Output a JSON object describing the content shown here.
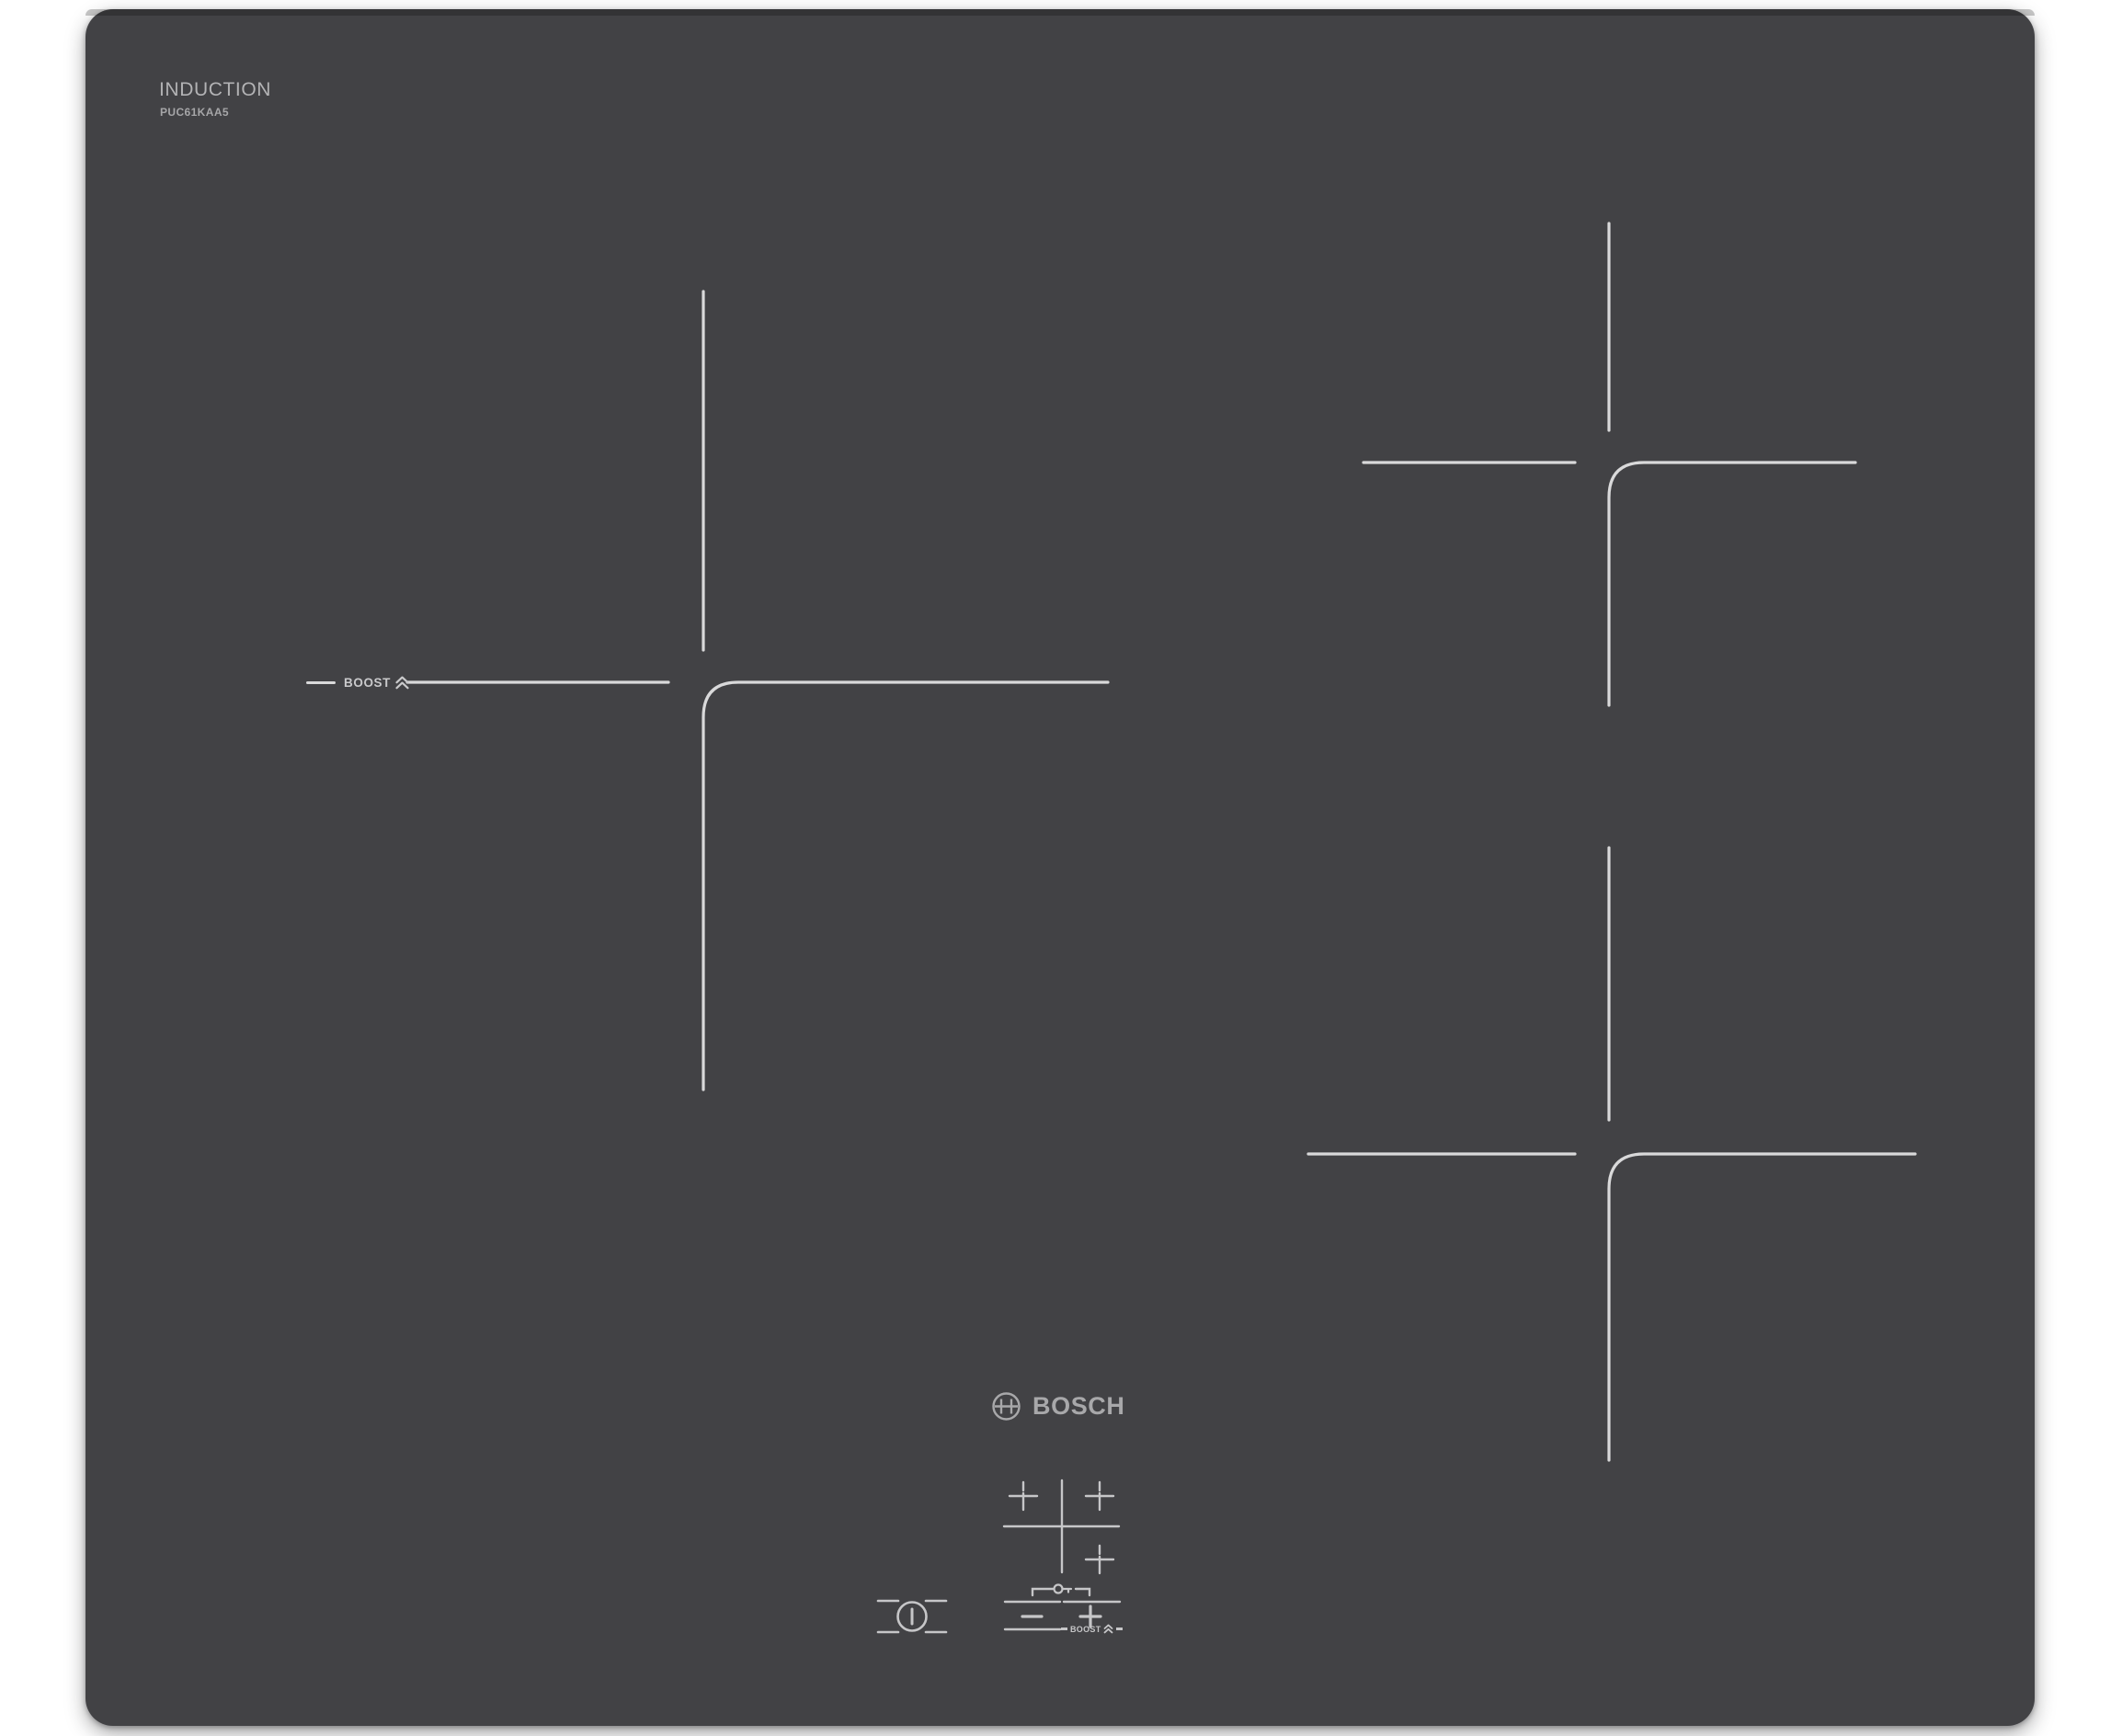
{
  "hob": {
    "header": {
      "title": "INDUCTION",
      "model": "PUC61KAA5"
    },
    "branding": {
      "logo_text": "BOSCH",
      "logo_icon": "bosch-armature-icon"
    },
    "left_zone": {
      "boost_label": "BOOST",
      "boost_icon": "double-chevron-up-icon"
    },
    "zones": {
      "marking_icon": "cooking-zone-cross-marking",
      "count": 3
    },
    "controls": {
      "power_icon": "power-icon",
      "childlock_icon": "key-icon",
      "zone_selector_icon": "hob-zone-map-icon",
      "minus_icon": "minus-icon",
      "plus_icon": "plus-icon",
      "boost_label": "BOOST",
      "boost_icon": "double-chevron-up-icon"
    },
    "colors": {
      "surface": "#424245",
      "surface_top_edge": "#343436",
      "marking_line": "#d9d9da",
      "control_line": "#c6c6c8",
      "title_text": "#b3b3b5",
      "logo_text": "#a8a8aa",
      "page_background": "#ffffff"
    }
  }
}
